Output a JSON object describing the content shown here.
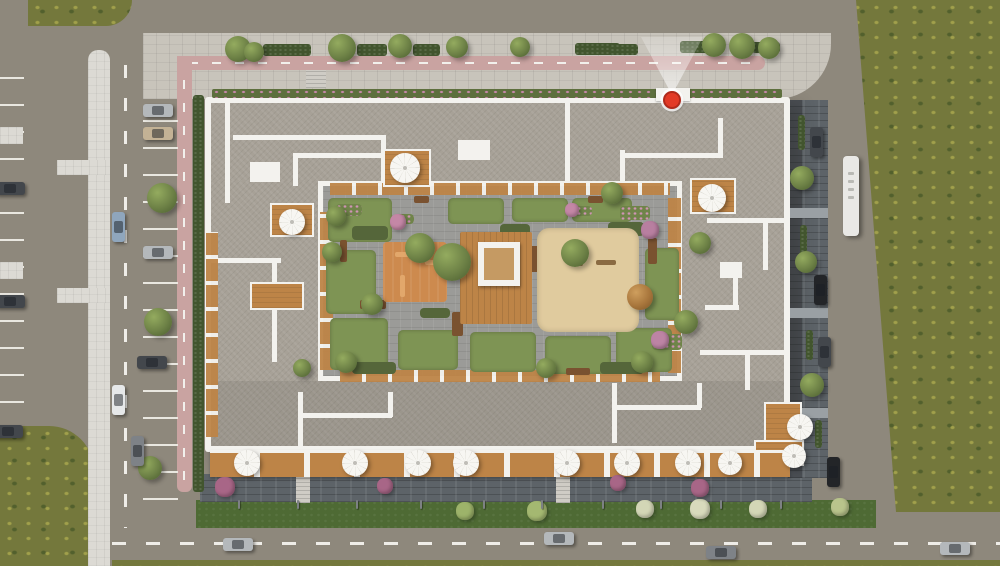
{
  "meta": {
    "scene": "aerial-architectural-render-of-residential-courtyard-block",
    "canvas_w": 1000,
    "canvas_h": 566
  },
  "palette": {
    "asphalt": "#8e887c",
    "pavers": "#c8c4bb",
    "walkway": "#dcdad4",
    "bike_lane": "#c9a3a1",
    "stall_line": "#e9e7e0",
    "dash": "#efede8",
    "hedge": "#42552e",
    "tree_light": "#94ab5f",
    "tree_mid": "#6d8146",
    "tree_dark": "#495c2e",
    "olive_grass": "#74783c",
    "lawn": "#4e6a34",
    "roof": "#a7a197",
    "parapet": "#f3f2ee",
    "courtyard": "#9b9b98",
    "dark_pavers": "#5d6368",
    "wood": "#bd8447",
    "play_orange": "#cd8a4e",
    "sand": "#e0cb9e",
    "umbrella": "#f6f5f1",
    "marker_red": "#e23a26",
    "lamp": "#7d8184",
    "car_silver": "#b4b8bb",
    "car_dark": "#43474c",
    "car_black": "#232528",
    "car_white": "#e6e8e9",
    "car_blue": "#8fa6bd",
    "car_grey": "#7e8287",
    "car_tan": "#c3b295",
    "bus": "#e9e8e5"
  },
  "marker": {
    "x": 672,
    "y": 100,
    "r": 9,
    "beam_w": 62,
    "beam_h": 58
  },
  "building": {
    "outer": [
      205,
      97,
      585,
      355
    ],
    "courtyard": [
      318,
      181,
      364,
      200
    ],
    "entrance": [
      656,
      88,
      34,
      13
    ],
    "roof_lines": [
      [
        233,
        135,
        153,
        5
      ],
      [
        381,
        135,
        5,
        51
      ],
      [
        293,
        153,
        93,
        5
      ],
      [
        293,
        153,
        5,
        33
      ],
      [
        250,
        162,
        30,
        20
      ],
      [
        565,
        103,
        5,
        82
      ],
      [
        458,
        140,
        32,
        20
      ],
      [
        620,
        150,
        5,
        36
      ],
      [
        625,
        153,
        95,
        5
      ],
      [
        718,
        118,
        5,
        40
      ],
      [
        707,
        218,
        78,
        5
      ],
      [
        763,
        222,
        5,
        48
      ],
      [
        720,
        262,
        22,
        16
      ],
      [
        733,
        278,
        5,
        30
      ],
      [
        705,
        305,
        34,
        5
      ],
      [
        700,
        350,
        84,
        5
      ],
      [
        745,
        355,
        5,
        35
      ],
      [
        225,
        103,
        5,
        100
      ],
      [
        211,
        258,
        70,
        5
      ],
      [
        272,
        262,
        5,
        100
      ],
      [
        298,
        392,
        5,
        54
      ],
      [
        302,
        413,
        90,
        5
      ],
      [
        388,
        392,
        5,
        25
      ],
      [
        612,
        383,
        5,
        60
      ],
      [
        616,
        405,
        85,
        5
      ],
      [
        697,
        383,
        5,
        25
      ]
    ],
    "decks": [
      [
        383,
        149,
        48,
        38
      ],
      [
        690,
        178,
        46,
        36
      ],
      [
        270,
        203,
        44,
        34
      ],
      [
        250,
        282,
        54,
        28
      ],
      [
        764,
        402,
        38,
        44
      ],
      [
        754,
        440,
        50,
        26
      ]
    ],
    "balcony_bands": [
      [
        330,
        183,
        340,
        12,
        "h"
      ],
      [
        668,
        198,
        13,
        175,
        "v"
      ],
      [
        320,
        212,
        13,
        158,
        "v"
      ],
      [
        340,
        370,
        320,
        12,
        "h"
      ],
      [
        206,
        232,
        12,
        205,
        "v"
      ]
    ],
    "terrace_band": [
      210,
      450,
      580,
      27
    ]
  },
  "courtyard_features": {
    "beds": [
      [
        328,
        198,
        64,
        44
      ],
      [
        326,
        250,
        50,
        64
      ],
      [
        330,
        318,
        58,
        52
      ],
      [
        398,
        330,
        60,
        40
      ],
      [
        470,
        332,
        66,
        40
      ],
      [
        545,
        336,
        66,
        38
      ],
      [
        616,
        328,
        56,
        44
      ],
      [
        448,
        198,
        56,
        26
      ],
      [
        512,
        198,
        56,
        24
      ],
      [
        572,
        198,
        60,
        24
      ],
      [
        645,
        248,
        34,
        72
      ]
    ],
    "dark_beds": [
      [
        352,
        226,
        36,
        14
      ],
      [
        500,
        224,
        30,
        12
      ],
      [
        608,
        222,
        36,
        14
      ],
      [
        420,
        308,
        30,
        10
      ],
      [
        560,
        310,
        40,
        10
      ],
      [
        352,
        362,
        44,
        12
      ],
      [
        600,
        362,
        44,
        12
      ]
    ],
    "flower_beds": [
      [
        336,
        204,
        26,
        12
      ],
      [
        620,
        206,
        30,
        14
      ],
      [
        652,
        334,
        30,
        16
      ],
      [
        394,
        214,
        20,
        10
      ],
      [
        570,
        206,
        22,
        10
      ]
    ],
    "planters": [
      [
        360,
        300,
        26,
        9
      ],
      [
        452,
        312,
        11,
        24
      ],
      [
        530,
        246,
        9,
        26
      ],
      [
        566,
        368,
        24,
        7
      ],
      [
        414,
        196,
        15,
        7
      ],
      [
        588,
        196,
        15,
        7
      ],
      [
        648,
        238,
        9,
        26
      ],
      [
        340,
        240,
        7,
        22
      ]
    ],
    "playground": [
      383,
      242,
      64,
      60
    ],
    "play_marks": [
      [
        395,
        252,
        30,
        5
      ],
      [
        400,
        275,
        5,
        22
      ],
      [
        425,
        260,
        14,
        5
      ]
    ],
    "deck": [
      460,
      232,
      72,
      92
    ],
    "pavilion": [
      478,
      242,
      42,
      44
    ],
    "sand": [
      537,
      228,
      102,
      104
    ],
    "sand_items": [
      [
        596,
        260,
        20,
        5
      ],
      [
        578,
        252,
        5,
        14
      ]
    ]
  },
  "trees": [
    [
      238,
      49,
      13
    ],
    [
      254,
      52,
      10
    ],
    [
      342,
      48,
      14
    ],
    [
      400,
      46,
      12
    ],
    [
      457,
      47,
      11
    ],
    [
      520,
      47,
      10
    ],
    [
      714,
      45,
      12
    ],
    [
      742,
      46,
      13
    ],
    [
      769,
      48,
      11
    ],
    [
      162,
      198,
      15
    ],
    [
      158,
      322,
      14
    ],
    [
      150,
      468,
      12
    ],
    [
      802,
      178,
      12
    ],
    [
      806,
      262,
      11
    ],
    [
      812,
      385,
      12
    ],
    [
      420,
      248,
      15
    ],
    [
      452,
      262,
      19
    ],
    [
      575,
      253,
      14
    ],
    [
      372,
      304,
      11
    ],
    [
      336,
      216,
      10
    ],
    [
      612,
      193,
      11
    ],
    [
      346,
      362,
      11
    ],
    [
      546,
      368,
      10
    ],
    [
      642,
      362,
      11
    ],
    [
      686,
      322,
      12
    ],
    [
      332,
      252,
      10
    ],
    [
      302,
      368,
      9
    ],
    [
      700,
      243,
      11
    ]
  ],
  "autumn_trees": [
    [
      640,
      297,
      13
    ]
  ],
  "bushes": [
    [
      465,
      511,
      9,
      "#9db36a"
    ],
    [
      537,
      511,
      10,
      "#a4b871"
    ],
    [
      645,
      509,
      9,
      "#d3d6b6"
    ],
    [
      700,
      509,
      10,
      "#d8dabc"
    ],
    [
      758,
      509,
      9,
      "#d3d6b6"
    ],
    [
      840,
      507,
      9,
      "#b9c48c"
    ],
    [
      225,
      487,
      10,
      "#a86687"
    ],
    [
      385,
      486,
      8,
      "#a86687"
    ],
    [
      700,
      488,
      9,
      "#a86687"
    ],
    [
      618,
      483,
      8,
      "#a86687"
    ],
    [
      398,
      222,
      8,
      "#c487a6"
    ],
    [
      650,
      230,
      9,
      "#b87fa0"
    ],
    [
      660,
      340,
      9,
      "#bd84a4"
    ],
    [
      572,
      210,
      7,
      "#c487a6"
    ]
  ],
  "hedges": [
    [
      263,
      44,
      48,
      12
    ],
    [
      357,
      44,
      30,
      12
    ],
    [
      413,
      44,
      27,
      12
    ],
    [
      575,
      43,
      45,
      12
    ],
    [
      610,
      44,
      28,
      11
    ],
    [
      680,
      41,
      32,
      12
    ],
    [
      752,
      42,
      28,
      11
    ],
    [
      193,
      95,
      11,
      397
    ],
    [
      798,
      115,
      7,
      35
    ],
    [
      800,
      225,
      7,
      30
    ],
    [
      806,
      330,
      7,
      30
    ],
    [
      815,
      420,
      7,
      28
    ]
  ],
  "flower_strip": [
    212,
    89,
    570,
    9
  ],
  "walkway_patches": [
    [
      0,
      127,
      23,
      17
    ],
    [
      0,
      262,
      23,
      17
    ],
    [
      57,
      160,
      53,
      15
    ],
    [
      57,
      288,
      53,
      15
    ]
  ],
  "steps": [
    [
      306,
      70,
      20,
      18
    ],
    [
      296,
      477,
      14,
      26
    ],
    [
      556,
      477,
      14,
      26
    ]
  ],
  "light_bands_east": [
    [
      790,
      208,
      38,
      10
    ],
    [
      790,
      308,
      38,
      10
    ],
    [
      790,
      408,
      38,
      10
    ]
  ],
  "cars": [
    [
      10,
      188,
      "h",
      "car_dark"
    ],
    [
      10,
      301,
      "h",
      "car_dark"
    ],
    [
      8,
      431,
      "h",
      "car_dark"
    ],
    [
      158,
      110,
      "h",
      "car_silver"
    ],
    [
      158,
      133,
      "h",
      "car_tan"
    ],
    [
      158,
      252,
      "h",
      "car_silver"
    ],
    [
      152,
      362,
      "h",
      "car_dark"
    ],
    [
      118,
      227,
      "v",
      "car_blue"
    ],
    [
      118,
      400,
      "v",
      "car_white"
    ],
    [
      137,
      451,
      "v",
      "car_grey"
    ],
    [
      816,
      142,
      "v",
      "car_dark"
    ],
    [
      820,
      290,
      "v",
      "car_black"
    ],
    [
      824,
      352,
      "v",
      "car_dark"
    ],
    [
      833,
      472,
      "v",
      "car_black"
    ],
    [
      238,
      544,
      "h",
      "car_silver"
    ],
    [
      559,
      538,
      "h",
      "car_silver"
    ],
    [
      721,
      552,
      "h",
      "car_grey"
    ],
    [
      955,
      548,
      "h",
      "car_silver"
    ]
  ],
  "bus": [
    851,
    196,
    16,
    80
  ],
  "umbrellas": [
    [
      405,
      168,
      30
    ],
    [
      712,
      198,
      28
    ],
    [
      292,
      222,
      26
    ],
    [
      800,
      427,
      26
    ],
    [
      794,
      456,
      24
    ],
    [
      247,
      463,
      26
    ],
    [
      355,
      463,
      26
    ],
    [
      418,
      463,
      26
    ],
    [
      466,
      463,
      26
    ],
    [
      567,
      463,
      26
    ],
    [
      627,
      463,
      26
    ],
    [
      688,
      463,
      26
    ],
    [
      730,
      463,
      24
    ]
  ],
  "lamp_posts": {
    "y": 500,
    "xs": [
      238,
      297,
      356,
      420,
      483,
      541,
      602,
      660,
      720,
      780
    ]
  }
}
